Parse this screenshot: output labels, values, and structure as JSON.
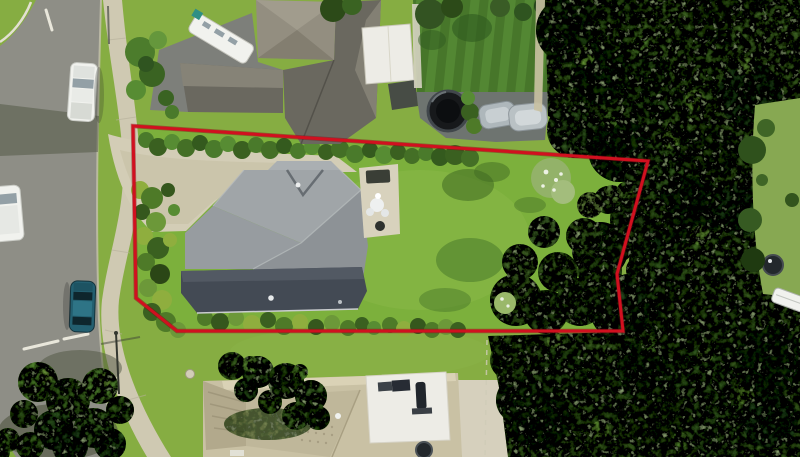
{
  "image": {
    "kind": "aerial-drone-photograph",
    "description": "Overhead aerial photo of a suburban section outlined with a red property-boundary line: gray hip-roof house with concrete driveway and large mown lawn, dense native bush along the right, street with parked cars at left, neighbouring houses above and below",
    "width_px": 800,
    "height_px": 457
  },
  "boundary": {
    "points": "133,126 648,161 617,274 623,331 177,331 136,298",
    "color": "#d1101f",
    "shadow_color": "#8a0715",
    "stroke_width": 3
  },
  "palette": {
    "baseGrass": "#86ad42",
    "propertyLawn": "#7cb03c",
    "neighborLawn": "#47762a",
    "neighborLawnStripe": "#538733",
    "clearingLawn": "#87a852",
    "road": "#8e8e86",
    "roadShadow": "#4e543f",
    "footpath": "#cfc9b2",
    "driveway": "#d3cdb6",
    "neighborDrive": "#7d7f7a",
    "patioDark": "#6e7470",
    "mainRoofLight": "#a0a5a8",
    "mainRoofMid": "#8d9296",
    "verandaRoof": "#434a54",
    "neighborRoofDark": "#6a685f",
    "neighborRoofLight": "#868377",
    "taupeRoof": "#938e80",
    "whiteRoof": "#edece6",
    "bottomRoofTan": "#c9c1a4",
    "bottomRoofLight": "#dad2b6",
    "bottomRoofDark": "#b2a98c",
    "concretePale": "#d6d0bd",
    "treeMid": "#3a5e23",
    "treeDark": "#244115",
    "treeLight": "#5d8c33",
    "white": "#f1f2ee",
    "glassGray": "#93a0a6",
    "carBlue": "#235f70",
    "spaBlack": "#17191b",
    "boundaryRed": "#d1101f",
    "boundaryShadow": "#8a0715"
  },
  "scene": {
    "objects": [
      {
        "name": "target-property-house",
        "detail": "gray hip roof with dark veranda roof along lower edge"
      },
      {
        "name": "property-driveway",
        "detail": "pale concrete driveway entering from street at left"
      },
      {
        "name": "property-lawn",
        "detail": "large bright mown lawn inside boundary"
      },
      {
        "name": "native-bush",
        "detail": "dense dark tree canopy along right side of section"
      },
      {
        "name": "neighbor-house-top",
        "detail": "dark gray roof, white flat roof, white caravan, round spa pool, striped lawn"
      },
      {
        "name": "neighbor-house-bottom",
        "detail": "tan tiled roof with white flat section and solar panels"
      },
      {
        "name": "street",
        "detail": "asphalt road with white ute, white van and blue car parked"
      },
      {
        "name": "footpath",
        "detail": "concrete footpath winding along the grass verge"
      },
      {
        "name": "right-clearing",
        "detail": "small lawn clearing with dark tank and white boat at far right"
      }
    ]
  }
}
